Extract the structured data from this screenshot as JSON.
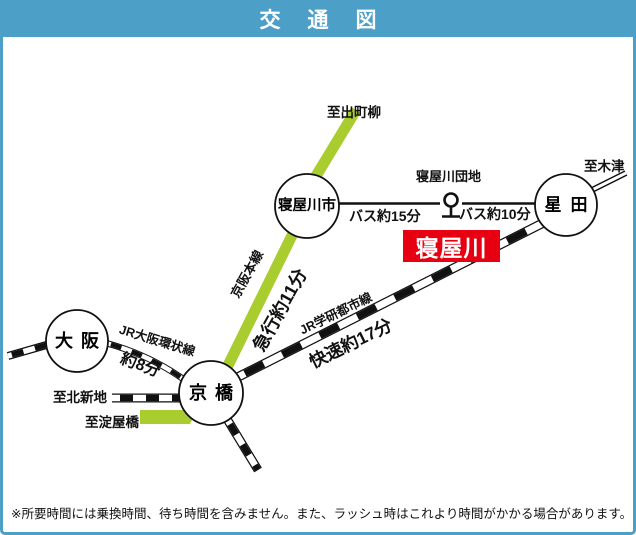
{
  "title": "交通図",
  "stations": {
    "osaka": "大阪",
    "kyobashi": "京橋",
    "neyagawashi": "寝屋川市",
    "hoshida": "星田"
  },
  "lines": {
    "jr_loop": {
      "name": "JR大阪環状線",
      "duration": "約8分"
    },
    "keihan": {
      "name": "京阪本線",
      "duration": "急行約11分"
    },
    "jr_gakken": {
      "name": "JR学研都市線",
      "duration": "快速約17分"
    }
  },
  "bus": {
    "stop_name": "寝屋川団地",
    "west_duration": "バス約15分",
    "east_duration": "バス約10分"
  },
  "directions": {
    "demachiyanagi": "至出町柳",
    "kizu": "至木津",
    "kitashinchi": "至北新地",
    "yodoyabashi": "至淀屋橋"
  },
  "highlight": {
    "label": "寝屋川"
  },
  "note": "※所要時間には乗換時間、待ち時間を含みません。また、ラッシュ時はこれより時間がかかる場合があります。",
  "colors": {
    "frame_blue": "#4c9fc6",
    "keihan_green": "#a9cc2f",
    "highlight_red": "#e60012",
    "rail_black": "#111111"
  }
}
